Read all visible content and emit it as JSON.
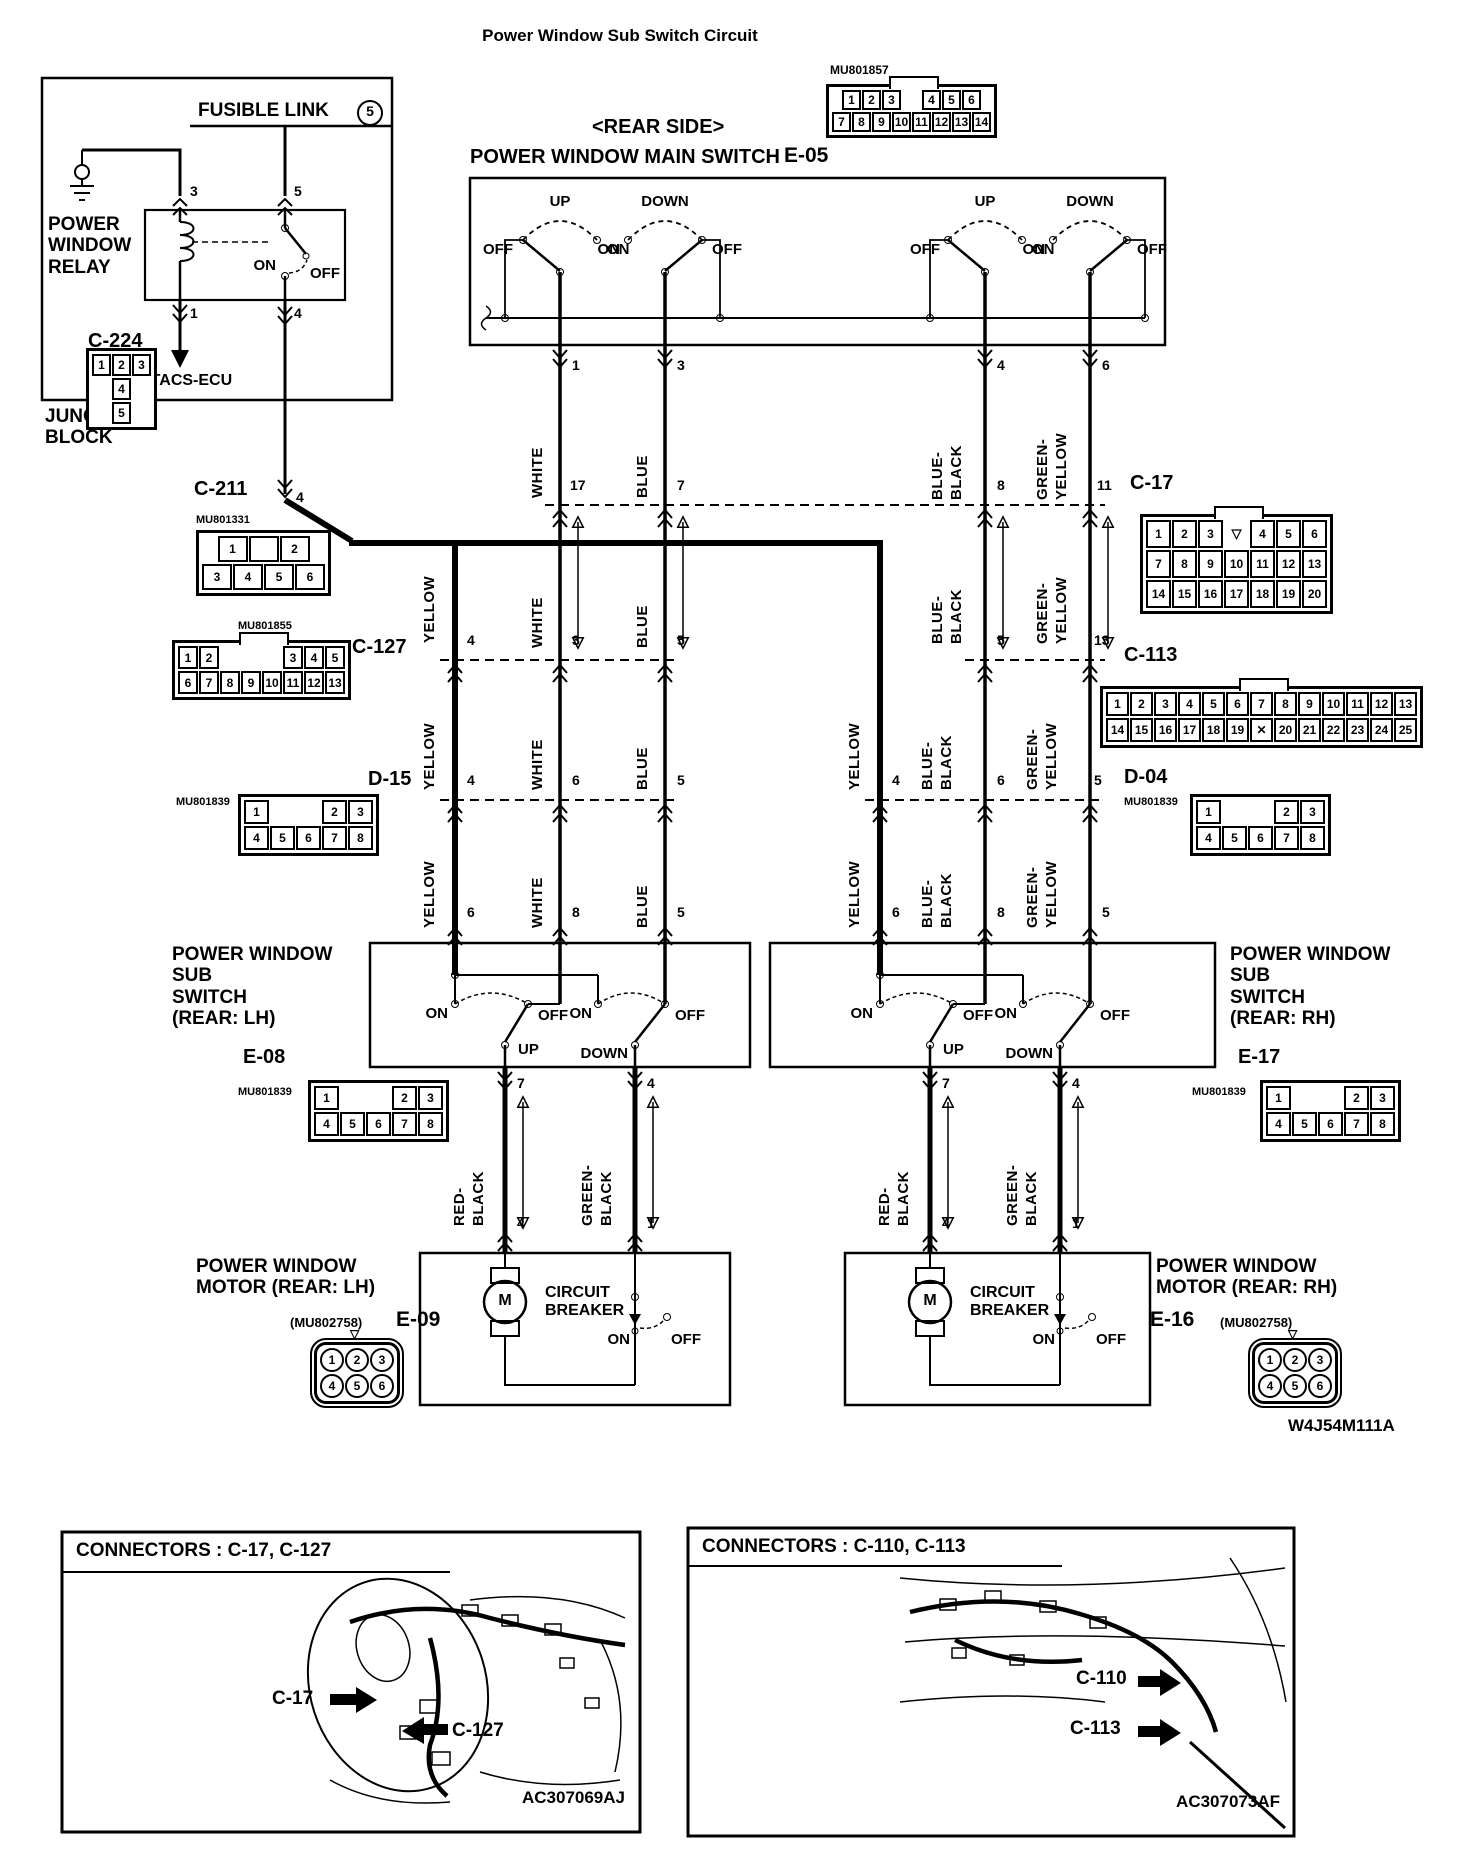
{
  "title": "Power Window Sub Switch Circuit",
  "diagram_id": "W4J54M111A",
  "junction_block": {
    "label": "JUNCTION\nBLOCK",
    "fusible_link": "FUSIBLE LINK",
    "fusible_link_num": "5",
    "relay": "POWER\nWINDOW\nRELAY",
    "relay_on": "ON",
    "relay_off": "OFF",
    "etacs": "ETACS-ECU",
    "pin_top_left": "3",
    "pin_top_right": "5",
    "pin_bot_left": "1",
    "pin_bot_right": "4"
  },
  "main_switch": {
    "rear_side": "<REAR SIDE>",
    "name": "POWER WINDOW MAIN SWITCH",
    "sw1_dir": "UP",
    "sw2_dir": "DOWN",
    "sw3_dir": "UP",
    "sw4_dir": "DOWN",
    "on": "ON",
    "off": "OFF"
  },
  "sub_switch_lh": {
    "name": "POWER WINDOW\nSUB\nSWITCH\n(REAR: LH)",
    "on": "ON",
    "off": "OFF",
    "up": "UP",
    "down": "DOWN"
  },
  "sub_switch_rh": {
    "name": "POWER WINDOW\nSUB\nSWITCH\n(REAR: RH)",
    "on": "ON",
    "off": "OFF",
    "up": "UP",
    "down": "DOWN"
  },
  "motor_lh": {
    "name": "POWER WINDOW\nMOTOR (REAR: LH)",
    "m": "M",
    "breaker": "CIRCUIT\nBREAKER",
    "on": "ON",
    "off": "OFF"
  },
  "motor_rh": {
    "name": "POWER WINDOW\nMOTOR (REAR: RH)",
    "m": "M",
    "breaker": "CIRCUIT\nBREAKER",
    "on": "ON",
    "off": "OFF"
  },
  "wire": {
    "yellow": "YELLOW",
    "white": "WHITE",
    "blue": "BLUE",
    "blue_black": "BLUE-\nBLACK",
    "green_yellow": "GREEN-\nYELLOW",
    "red_black": "RED-\nBLACK",
    "green_black": "GREEN-\nBLACK"
  },
  "pins": {
    "c211": "4",
    "main_out": [
      "1",
      "3",
      "4",
      "6"
    ],
    "c17": [
      "17",
      "7",
      "8",
      "11"
    ],
    "c127": [
      "4",
      "3",
      "5"
    ],
    "c113": [
      "5",
      "13"
    ],
    "d15": [
      "4",
      "6",
      "5"
    ],
    "d04": [
      "4",
      "6",
      "5"
    ],
    "sub_in": [
      "6",
      "8",
      "5"
    ],
    "sub_out": [
      "7",
      "4"
    ],
    "motor_in": [
      "4",
      "1"
    ]
  },
  "connectors": {
    "c224": {
      "label": "C-224",
      "rows": [
        [
          "1",
          "2",
          "3"
        ],
        [
          "4"
        ],
        [
          "5"
        ]
      ]
    },
    "c211": {
      "label": "C-211",
      "part": "MU801331",
      "rows": [
        [
          "1",
          "",
          "2"
        ],
        [
          "3",
          "4",
          "5",
          "6"
        ]
      ]
    },
    "e05": {
      "label": "E-05",
      "part": "MU801857",
      "rows": [
        [
          "1",
          "2",
          "3",
          "gap",
          "4",
          "5",
          "6"
        ],
        [
          "7",
          "8",
          "9",
          "10",
          "11",
          "12",
          "13",
          "14"
        ]
      ]
    },
    "c17": {
      "label": "C-17",
      "rows": [
        [
          "1",
          "2",
          "3",
          "▽",
          "4",
          "5",
          "6"
        ],
        [
          "7",
          "8",
          "9",
          "10",
          "11",
          "12",
          "13"
        ],
        [
          "14",
          "15",
          "16",
          "17",
          "18",
          "19",
          "20"
        ]
      ]
    },
    "c127": {
      "label": "C-127",
      "part": "MU801855",
      "rows": [
        [
          "1",
          "2",
          "gap",
          "gap",
          "gap",
          "3",
          "4",
          "5"
        ],
        [
          "6",
          "7",
          "8",
          "9",
          "10",
          "11",
          "12",
          "13"
        ]
      ]
    },
    "c113": {
      "label": "C-113",
      "rows": [
        [
          "1",
          "2",
          "3",
          "4",
          "5",
          "6",
          "7",
          "8",
          "9",
          "10",
          "11",
          "12",
          "13"
        ],
        [
          "14",
          "15",
          "16",
          "17",
          "18",
          "19",
          "x",
          "20",
          "21",
          "22",
          "23",
          "24",
          "25"
        ]
      ]
    },
    "d15": {
      "label": "D-15",
      "part": "MU801839",
      "rows": [
        [
          "1",
          "gap",
          "gap",
          "2",
          "3"
        ],
        [
          "4",
          "5",
          "6",
          "7",
          "8"
        ]
      ]
    },
    "d04": {
      "label": "D-04",
      "part": "MU801839",
      "rows": [
        [
          "1",
          "gap",
          "gap",
          "2",
          "3"
        ],
        [
          "4",
          "5",
          "6",
          "7",
          "8"
        ]
      ]
    },
    "e08": {
      "label": "E-08",
      "part": "MU801839",
      "rows": [
        [
          "1",
          "gap",
          "gap",
          "2",
          "3"
        ],
        [
          "4",
          "5",
          "6",
          "7",
          "8"
        ]
      ]
    },
    "e17": {
      "label": "E-17",
      "part": "MU801839",
      "rows": [
        [
          "1",
          "gap",
          "gap",
          "2",
          "3"
        ],
        [
          "4",
          "5",
          "6",
          "7",
          "8"
        ]
      ]
    },
    "e09": {
      "label": "E-09",
      "part": "(MU802758)",
      "rows": [
        [
          "1",
          "2",
          "3"
        ],
        [
          "4",
          "5",
          "6"
        ]
      ]
    },
    "e16": {
      "label": "E-16",
      "part": "(MU802758)",
      "rows": [
        [
          "1",
          "2",
          "3"
        ],
        [
          "4",
          "5",
          "6"
        ]
      ]
    }
  },
  "footer_left": {
    "header": "CONNECTORS : C-17, C-127",
    "tag1": "C-17",
    "tag2": "C-127",
    "code": "AC307069AJ"
  },
  "footer_right": {
    "header": "CONNECTORS : C-110, C-113",
    "tag1": "C-110",
    "tag2": "C-113",
    "code": "AC307073AF"
  }
}
